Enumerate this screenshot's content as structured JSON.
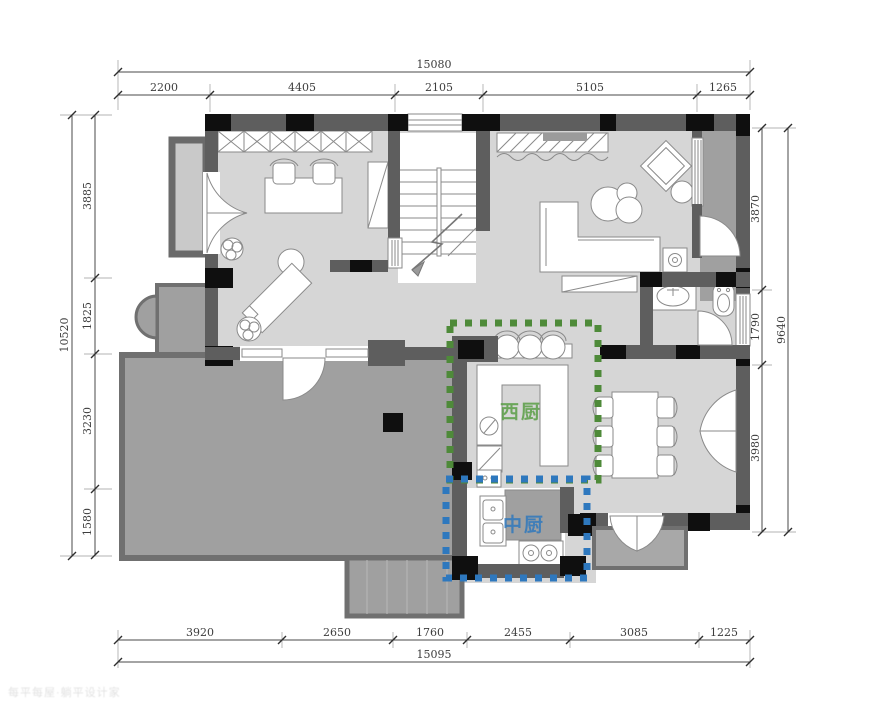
{
  "rooms": {
    "west_kitchen_label": "西厨",
    "chinese_kitchen_label": "中厨"
  },
  "colors": {
    "west_green": "#4e8a39",
    "west_label": "#5a9e46",
    "mid_blue": "#2e78be",
    "mid_label": "#3079bd"
  },
  "dims": {
    "top": {
      "total": "15080",
      "segments": [
        "2200",
        "4405",
        "2105",
        "5105",
        "1265"
      ]
    },
    "left": {
      "total": "10520",
      "segments": [
        "3885",
        "1825",
        "3230",
        "1580"
      ]
    },
    "right": {
      "total": "9640",
      "segments": [
        "3870",
        "1790",
        "3980"
      ]
    },
    "bottom": {
      "total": "15095",
      "segments": [
        "3920",
        "2650",
        "1760",
        "2455",
        "3085",
        "1225"
      ]
    }
  },
  "watermark": {
    "text": "每平每屋·躺平设计家"
  }
}
